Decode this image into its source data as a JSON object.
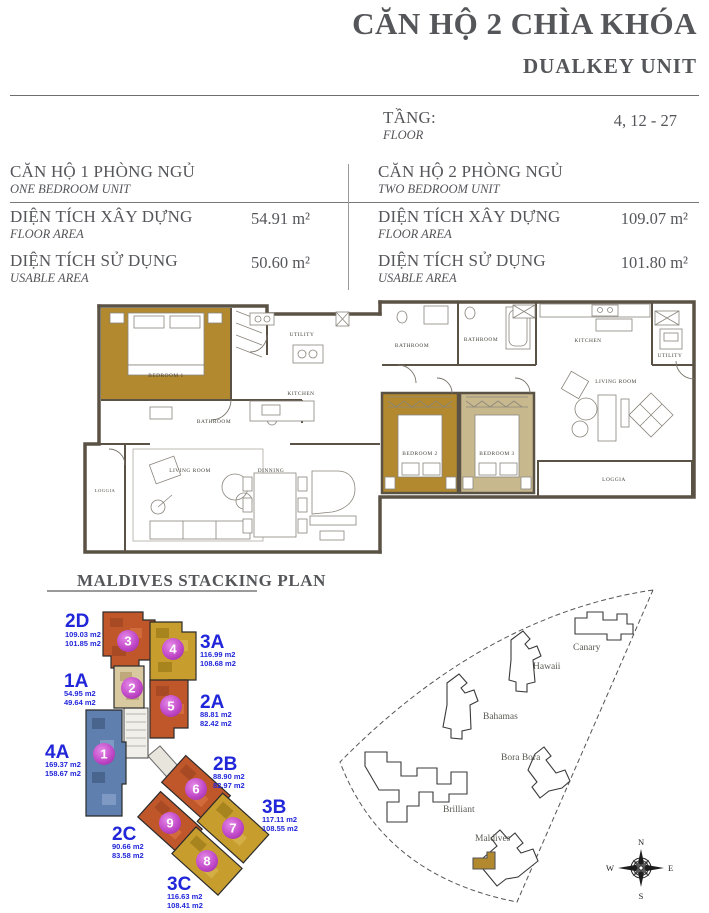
{
  "header": {
    "title_vi": "CĂN HỘ 2 CHÌA KHÓA",
    "title_en": "DUALKEY UNIT"
  },
  "floor": {
    "label_vi": "TẦNG:",
    "label_en": "FLOOR",
    "value": "4, 12 - 27"
  },
  "units": [
    {
      "name_vi": "CĂN HỘ 1 PHÒNG NGỦ",
      "name_en": "ONE BEDROOM UNIT",
      "rows": [
        {
          "label_vi": "DIỆN TÍCH XÂY DỰNG",
          "label_en": "FLOOR AREA",
          "value": "54.91 m²"
        },
        {
          "label_vi": "DIỆN TÍCH SỬ DỤNG",
          "label_en": "USABLE AREA",
          "value": "50.60 m²"
        }
      ]
    },
    {
      "name_vi": "CĂN HỘ 2 PHÒNG NGỦ",
      "name_en": "TWO BEDROOM UNIT",
      "rows": [
        {
          "label_vi": "DIỆN TÍCH XÂY DỰNG",
          "label_en": "FLOOR AREA",
          "value": "109.07 m²"
        },
        {
          "label_vi": "DIỆN TÍCH SỬ DỤNG",
          "label_en": "USABLE AREA",
          "value": "101.80 m²"
        }
      ]
    }
  ],
  "plan": {
    "labels": {
      "bedroom1": "BEDROOM 1",
      "bedroom2": "BEDROOM 2",
      "bedroom3": "BEDROOM 3",
      "bathroom": "BATHROOM",
      "utility": "UTILITY",
      "kitchen": "KITCHEN",
      "living_room": "LIVING ROOM",
      "dinning": "DINNING",
      "loggia": "LOGGIA"
    }
  },
  "stacking": {
    "title": "MALDIVES STACKING PLAN",
    "units": [
      {
        "code": "2D",
        "number": "3",
        "floor_area": "109.03 m2",
        "usable_area": "101.85 m2"
      },
      {
        "code": "3A",
        "number": "4",
        "floor_area": "116.99 m2",
        "usable_area": "108.68 m2"
      },
      {
        "code": "1A",
        "number": "2",
        "floor_area": "54.95 m2",
        "usable_area": "49.64 m2"
      },
      {
        "code": "2A",
        "number": "5",
        "floor_area": "88.81 m2",
        "usable_area": "82.42 m2"
      },
      {
        "code": "4A",
        "number": "1",
        "floor_area": "169.37 m2",
        "usable_area": "158.67 m2"
      },
      {
        "code": "2B",
        "number": "6",
        "floor_area": "88.90 m2",
        "usable_area": "82.97 m2"
      },
      {
        "code": "3B",
        "number": "7",
        "floor_area": "117.11 m2",
        "usable_area": "108.55 m2"
      },
      {
        "code": "2C",
        "number": "9",
        "floor_area": "90.66 m2",
        "usable_area": "83.58 m2"
      },
      {
        "code": "3C",
        "number": "8",
        "floor_area": "116.63 m2",
        "usable_area": "108.41 m2"
      }
    ]
  },
  "site": {
    "buildings": {
      "canary": "Canary",
      "hawaii": "Hawaii",
      "bahamas": "Bahamas",
      "bora_bora": "Bora Bora",
      "brilliant": "Brilliant",
      "maldives": "Maldives"
    },
    "compass": {
      "n": "N",
      "e": "E",
      "s": "S",
      "w": "W"
    }
  },
  "colors": {
    "accent_blue": "#2126d9",
    "unit_orange": "#c0572b",
    "unit_gold": "#c79d2e",
    "unit_blue": "#5f7fae",
    "unit_cream": "#d9c9a1",
    "unit_tan": "#c8b88e",
    "bedroom_gold": "#b3892f",
    "wall": "#5b5246",
    "circle_magenta": "#c149c8",
    "text_gray": "#57585a"
  }
}
